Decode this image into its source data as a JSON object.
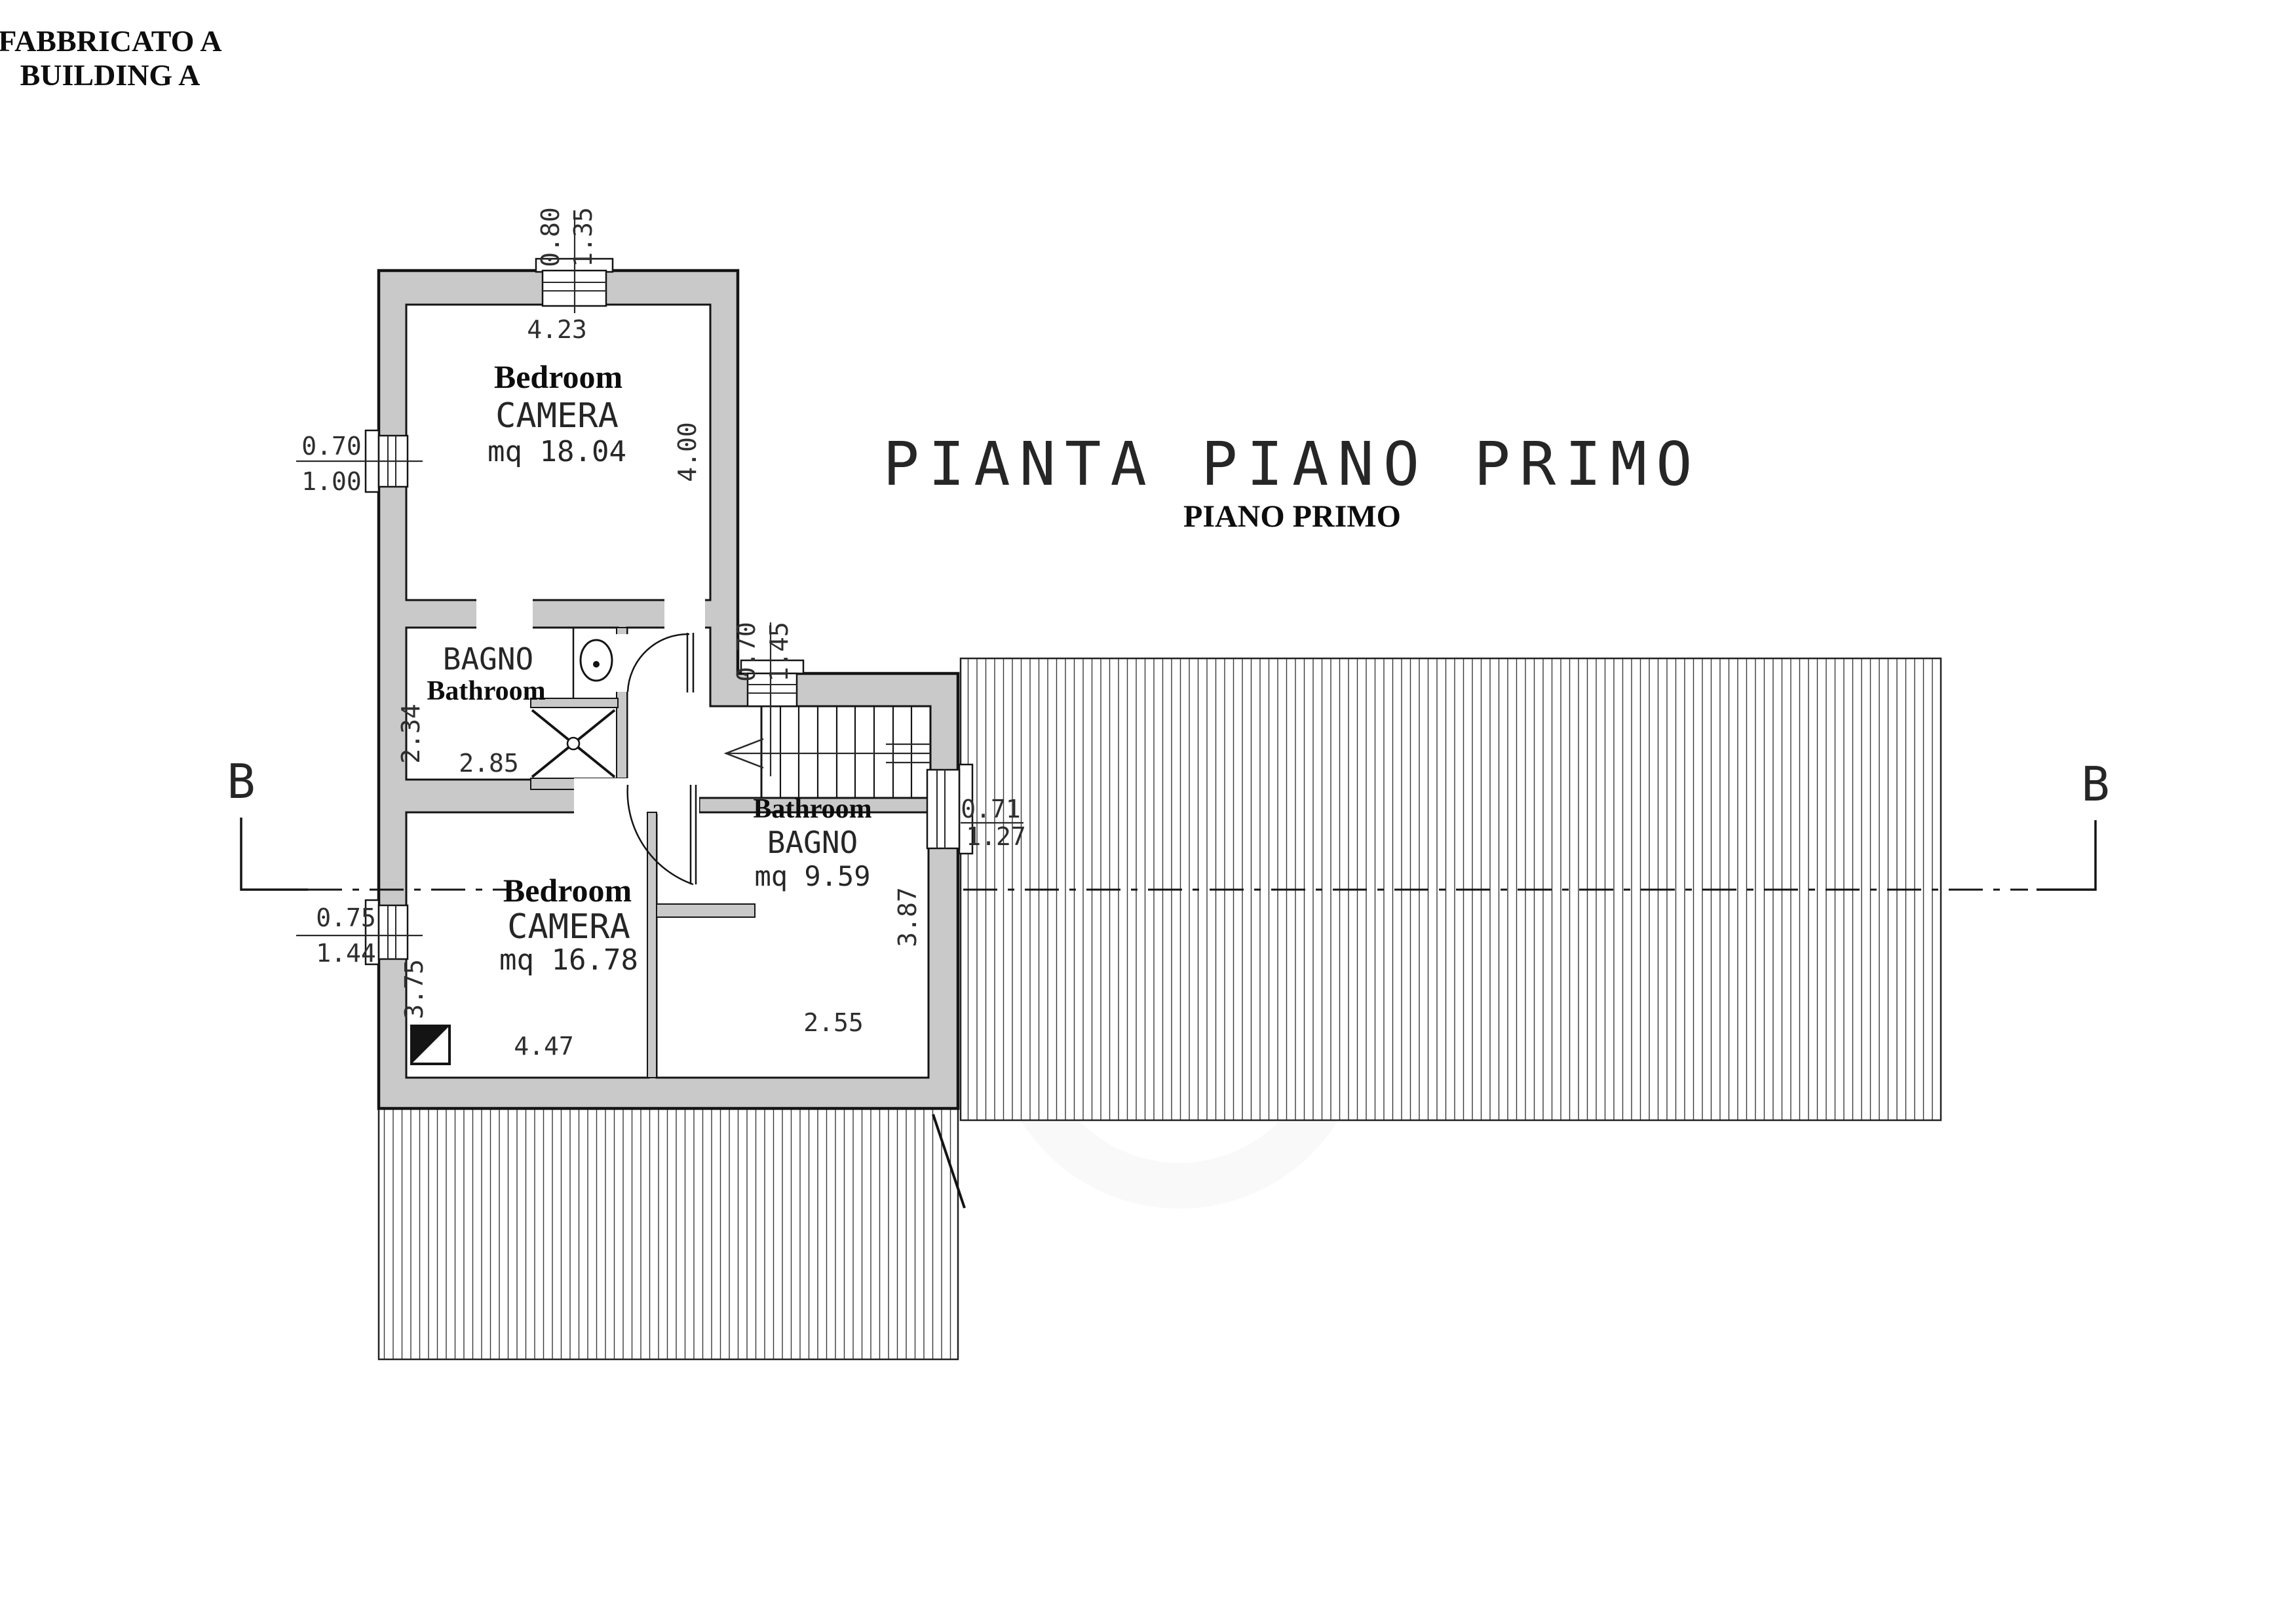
{
  "header": {
    "line1": "FABBRICATO A",
    "line2": "BUILDING A"
  },
  "title": {
    "main": "PIANTA PIANO PRIMO",
    "sub": "PIANO PRIMO"
  },
  "rooms": {
    "bedroom_upper": {
      "name_en": "Bedroom",
      "name_it": "CAMERA",
      "area": "mq 18.04"
    },
    "bathroom_upper": {
      "name_it": "BAGNO",
      "name_en": "Bathroom"
    },
    "bedroom_lower": {
      "name_en": "Bedroom",
      "name_it": "CAMERA",
      "area": "mq 16.78"
    },
    "bathroom_lower": {
      "name_en": "Bathroom",
      "name_it": "BAGNO",
      "area": "mq 9.59"
    }
  },
  "dims": {
    "top_window_w": "0.80",
    "top_window_h": "1.35",
    "room1_w": "4.23",
    "room1_h": "4.00",
    "win_ul_w": "0.70",
    "win_ul_h": "1.00",
    "bath1_h": "2.34",
    "bath1_w": "2.85",
    "stair_window_w": "0.70",
    "stair_window_h": "1.45",
    "win_ll_w": "0.75",
    "win_ll_h": "1.44",
    "room2_h": "3.75",
    "room2_w": "4.47",
    "bath2_h": "3.87",
    "bath2_w": "2.55",
    "bath2_window_w": "0.71",
    "bath2_window_h": "1.27"
  },
  "section_markers": {
    "left": "B",
    "right": "B"
  },
  "colors": {
    "wall_fill": "#c9c9c9",
    "line": "#141414",
    "hatch": "#383838",
    "paper": "#ffffff"
  }
}
